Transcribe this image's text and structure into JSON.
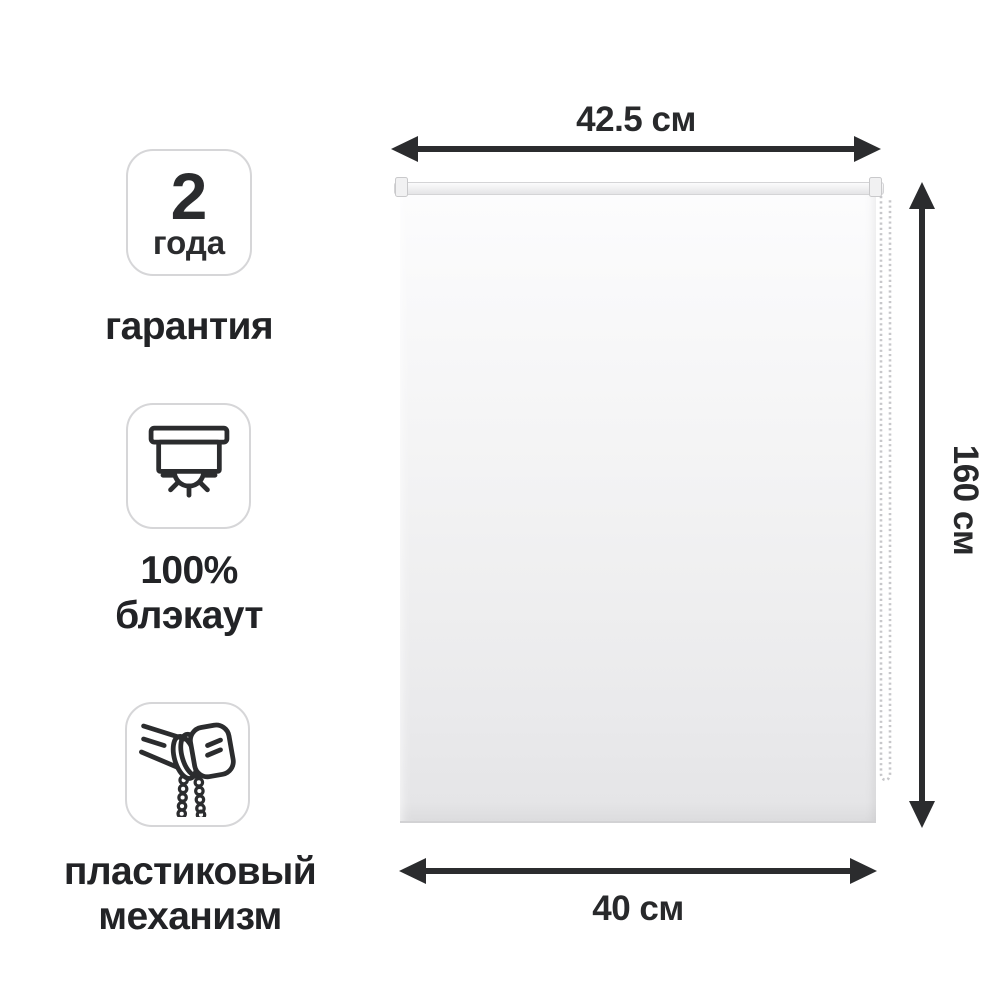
{
  "page": {
    "background": "#ffffff"
  },
  "features": [
    {
      "id": "warranty",
      "icon": "warranty-2-years-badge",
      "badge_value": "2",
      "badge_unit": "года",
      "label_lines": [
        "гарантия"
      ]
    },
    {
      "id": "blackout",
      "icon": "blackout-blind-icon",
      "label_lines": [
        "100%",
        "блэкаут"
      ]
    },
    {
      "id": "mechanism",
      "icon": "roller-mechanism-icon",
      "label_lines": [
        "пластиковый",
        "механизм"
      ]
    }
  ],
  "dimensions": {
    "top": "42.5 см",
    "right": "160 см",
    "bottom": "40 см"
  },
  "colors": {
    "text": "#222326",
    "arrow": "#2b2c2e",
    "badge_border": "#d6d6d8",
    "fabric_top": "#fcfcfd",
    "fabric_bottom": "#e5e5e7"
  }
}
